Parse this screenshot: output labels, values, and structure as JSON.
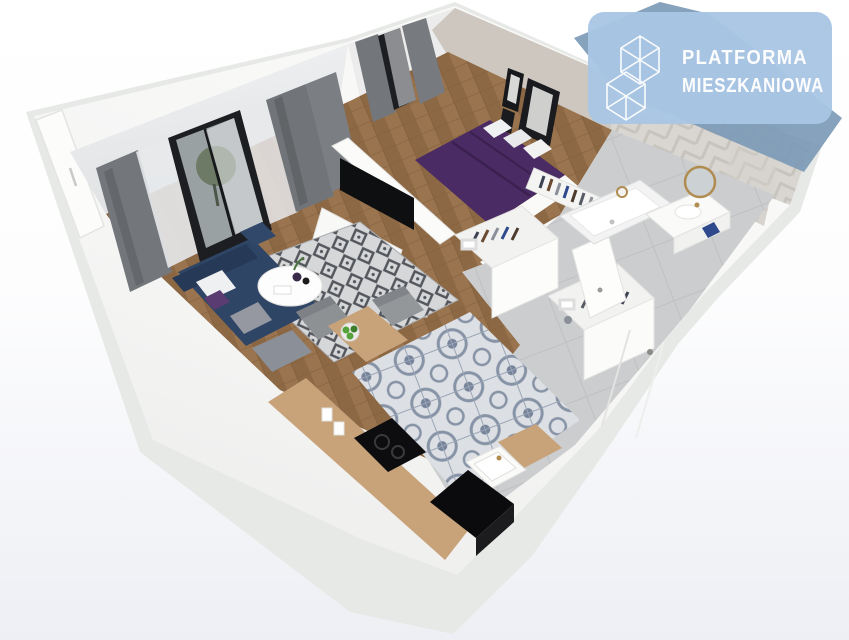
{
  "brand_badge": {
    "line1": "PLATFORMA",
    "line2": "MIESZKANIOWA",
    "icon": "wireframe-cubes-icon",
    "badge_color": "#a9c6e4",
    "backdrop_color": "#7d9ab6",
    "text_color": "#fdfdfe"
  },
  "scene": {
    "kind": "3D cutaway axonometric render of a one-bedroom apartment floor plan",
    "background_top": "#ffffff",
    "background_bottom": "#edeff4",
    "palette": {
      "slab": "#e7e9e7",
      "wall_white": "#f7f7f6",
      "wall_face": "#eef0f1",
      "bedroom_wall": "#cdc7bf",
      "bath_wall": "#d9d6d1",
      "bath_wall_line": "#c7c3bd",
      "wood_floor": "#9a744e",
      "wood_floor_line": "#84613f",
      "gray_tile": "#cbcdcf",
      "tile_grout": "#bec0c2",
      "kitchen_tile_bg": "#dcdfe3",
      "kitchen_tile_motif": "#8793a6",
      "rug_bg": "#d6d7d9",
      "rug_motif": "#53565c",
      "curtain": "#73767b",
      "sheer": "#e7e9eb",
      "window_frame": "#1c1e21",
      "glass": "#9aa1a3",
      "tree": "#67755f",
      "sofa": "#2f4566",
      "sofa_dark": "#263a57",
      "bed": "#4a2b63",
      "bed_fold": "#3a2150",
      "pillow": "#eff0f1",
      "cabinet_white": "#f8f8f7",
      "counter_wood": "#c8a279",
      "cooktop": "#0d0d0f",
      "shaft": "#0b0b0d",
      "tv_black": "#0e0f11",
      "plant": "#4a7340",
      "apple_green": "#58a23b",
      "gold": "#b08c50",
      "towel_blue": "#2e4a8c",
      "chair_gray": "#8e9194"
    },
    "rooms": [
      {
        "name": "living-room",
        "items": [
          "gray-curtains",
          "balcony-door",
          "navy-sofa",
          "diamond-rug",
          "round-coffee-table",
          "tv-sideboard",
          "tv",
          "potted-plant"
        ]
      },
      {
        "name": "dining-kitchen",
        "items": [
          "wood-dining-table",
          "gray-chairs",
          "fruit-bowl",
          "l-shaped-counter",
          "cooktop",
          "kitchen-sink",
          "patterned-tiles",
          "utility-shaft"
        ]
      },
      {
        "name": "bedroom",
        "items": [
          "purple-double-bed",
          "white-pillows",
          "wall-art",
          "open-wardrobe-with-clothes",
          "window-curtains"
        ]
      },
      {
        "name": "hallway",
        "items": [
          "wardrobes-with-clothes",
          "open-door",
          "entrance-door",
          "gray-tile-floor"
        ]
      },
      {
        "name": "bathroom",
        "items": [
          "bathtub",
          "vanity-with-sink",
          "round-gold-mirror",
          "herringbone-tile-wall",
          "towel"
        ]
      }
    ]
  }
}
